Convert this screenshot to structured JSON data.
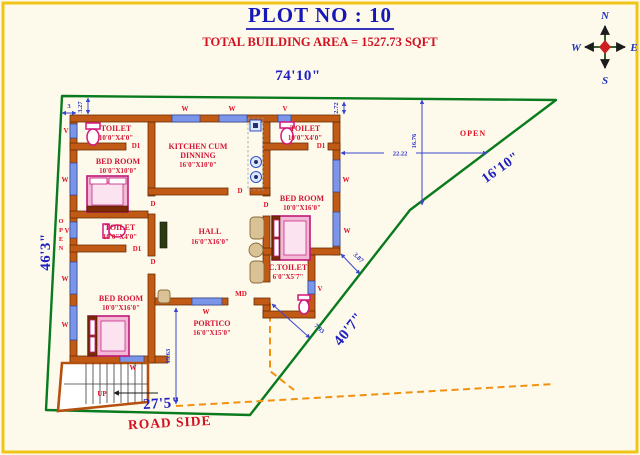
{
  "header": {
    "title": "PLOT NO : 10",
    "subtitle": "TOTAL BUILDING AREA = 1527.73 SQFT"
  },
  "plot": {
    "top": "74'10\"",
    "left": "46'3\"",
    "right_upper": "16'10\"",
    "right_lower": "40'7\"",
    "bottom": "27'5\"",
    "road": "ROAD SIDE",
    "open_right": "OPEN",
    "open_left_letters": [
      "O",
      "P",
      "E",
      "N"
    ]
  },
  "rooms": {
    "toilet_top_left": {
      "name": "TOILET",
      "size": "10'0\"X4'0\""
    },
    "kitchen": {
      "line1": "KITCHEN CUM",
      "line2": "DINNING",
      "size": "16'0\"X10'0\""
    },
    "toilet_top_right": {
      "name": "TOILET",
      "size": "10'0\"X4'0\""
    },
    "bedroom_top_left": {
      "name": "BED ROOM",
      "size": "10'0\"X10'0\""
    },
    "toilet_mid_left": {
      "name": "TOILET",
      "size": "10'0\"X4'0\""
    },
    "hall": {
      "name": "HALL",
      "size": "16'0\"X16'0\""
    },
    "bedroom_right": {
      "name": "BED ROOM",
      "size": "10'0\"X16'0\""
    },
    "c_toilet": {
      "name": "C.TOILET",
      "size": "6'0\"X5'7\""
    },
    "bedroom_bottom_left": {
      "name": "BED ROOM",
      "size": "10'0\"X16'0\""
    },
    "portico": {
      "name": "PORTICO",
      "size": "16'0\"X15'0\""
    }
  },
  "marks": {
    "window": "W",
    "vent": "V",
    "door": "D",
    "door1": "D1",
    "main_door": "MD",
    "up": "UP"
  },
  "dims": {
    "m3": "3",
    "m327": "3.27",
    "m272": "2.72",
    "m1676": "16.76",
    "m2222": "22.22",
    "m387": "3.87",
    "m793": "7.93",
    "m1563": "15.63"
  },
  "compass": {
    "n": "N",
    "e": "E",
    "s": "S",
    "w": "W"
  },
  "colors": {
    "title_blue": "#1717b8",
    "label_red": "#d41535",
    "wall_orange": "#c05a14",
    "boundary_green": "#0a7a1e",
    "dash_orange": "#f29110",
    "window_blue": "#7b96e8",
    "dim_blue": "#2c35c8",
    "frame_yellow": "#f1c418"
  }
}
